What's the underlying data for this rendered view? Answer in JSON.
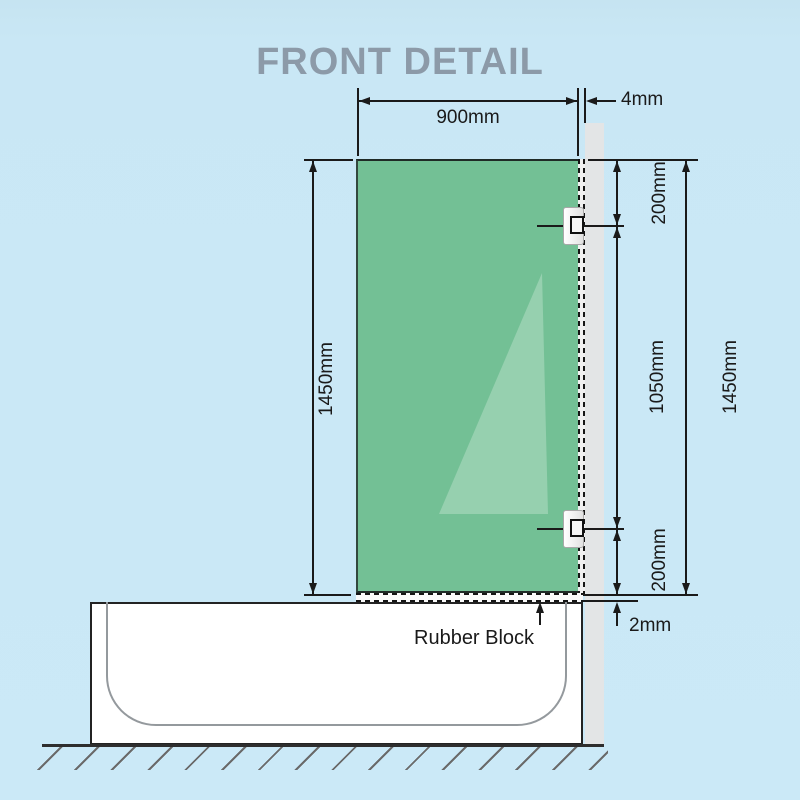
{
  "title": "FRONT DETAIL",
  "dimensions": {
    "glass_width": "900mm",
    "glass_thickness": "4mm",
    "top_bracket_offset": "200mm",
    "bracket_spacing": "1050mm",
    "bottom_bracket_offset": "200mm",
    "panel_height_right": "1450mm",
    "panel_height_left": "1450mm",
    "rubber_gap": "2mm"
  },
  "annotations": {
    "rubber_block": "Rubber Block"
  },
  "colors": {
    "background": "#cbe9f7",
    "title_text": "#8c9aa8",
    "glass": "#73c095",
    "glass_highlight": "rgba(255,255,255,0.25)",
    "wall_post": "#e3e5e6",
    "tub_fill": "#ffffff",
    "line": "#1a1a1a"
  }
}
